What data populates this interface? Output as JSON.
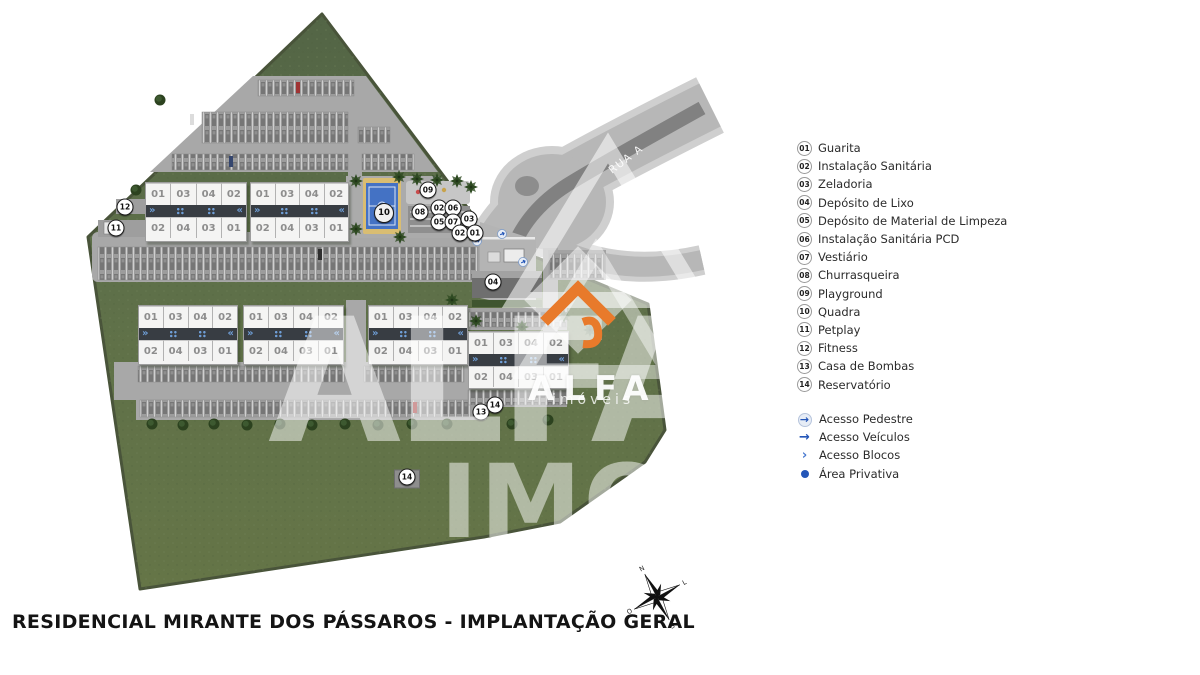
{
  "title": "RESIDENCIAL MIRANTE DOS PÁSSAROS - IMPLANTAÇÃO GERAL",
  "road": {
    "label": "RUA A"
  },
  "legend": {
    "items": [
      {
        "num": "01",
        "label": "Guarita"
      },
      {
        "num": "02",
        "label": "Instalação Sanitária"
      },
      {
        "num": "03",
        "label": "Zeladoria"
      },
      {
        "num": "04",
        "label": "Depósito de Lixo"
      },
      {
        "num": "05",
        "label": "Depósito de Material de Limpeza"
      },
      {
        "num": "06",
        "label": "Instalação Sanitária PCD"
      },
      {
        "num": "07",
        "label": "Vestiário"
      },
      {
        "num": "08",
        "label": "Churrasqueira"
      },
      {
        "num": "09",
        "label": "Playground"
      },
      {
        "num": "10",
        "label": "Quadra"
      },
      {
        "num": "11",
        "label": "Petplay"
      },
      {
        "num": "12",
        "label": "Fitness"
      },
      {
        "num": "13",
        "label": "Casa de Bombas"
      },
      {
        "num": "14",
        "label": "Reservatório"
      }
    ]
  },
  "access": {
    "items": [
      {
        "icon": "pedestrian-access-icon",
        "glyph": "→",
        "label": "Acesso Pedestre"
      },
      {
        "icon": "vehicle-access-icon",
        "glyph": "→",
        "label": "Acesso Veículos"
      },
      {
        "icon": "block-access-icon",
        "glyph": "›",
        "label": "Acesso Blocos"
      },
      {
        "icon": "private-area-icon",
        "glyph": "",
        "label": "Área Privativa"
      }
    ]
  },
  "plan": {
    "top_units": [
      "01",
      "03",
      "04",
      "02"
    ],
    "bottom_units": [
      "02",
      "04",
      "03",
      "01"
    ],
    "chevron_left": "»",
    "chevron_right": "«",
    "blocks": [
      {
        "x": 145,
        "y": 182,
        "w": 100,
        "h": 58
      },
      {
        "x": 250,
        "y": 182,
        "w": 97,
        "h": 58
      },
      {
        "x": 138,
        "y": 305,
        "w": 98,
        "h": 58
      },
      {
        "x": 243,
        "y": 305,
        "w": 99,
        "h": 58
      },
      {
        "x": 368,
        "y": 305,
        "w": 98,
        "h": 58
      },
      {
        "x": 468,
        "y": 331,
        "w": 99,
        "h": 56
      }
    ],
    "badges": [
      {
        "n": "12",
        "x": 125,
        "y": 207
      },
      {
        "n": "11",
        "x": 116,
        "y": 228
      },
      {
        "n": "09",
        "x": 428,
        "y": 190
      },
      {
        "n": "10",
        "x": 384,
        "y": 213,
        "size": "lg"
      },
      {
        "n": "08",
        "x": 420,
        "y": 212
      },
      {
        "n": "02",
        "x": 439,
        "y": 208
      },
      {
        "n": "06",
        "x": 453,
        "y": 208
      },
      {
        "n": "05",
        "x": 439,
        "y": 222
      },
      {
        "n": "07",
        "x": 453,
        "y": 222
      },
      {
        "n": "03",
        "x": 469,
        "y": 219
      },
      {
        "n": "02",
        "x": 460,
        "y": 233
      },
      {
        "n": "01",
        "x": 475,
        "y": 233
      },
      {
        "n": "04",
        "x": 493,
        "y": 282
      },
      {
        "n": "13",
        "x": 481,
        "y": 412
      },
      {
        "n": "14",
        "x": 495,
        "y": 405
      },
      {
        "n": "14",
        "x": 407,
        "y": 477,
        "plate": true
      }
    ],
    "compass": {
      "n": "N",
      "e": "L",
      "s": "S",
      "w": "O"
    }
  },
  "watermark": {
    "brand": "ALFA",
    "brand_sub": "imóveis",
    "giant_top": "ALFA",
    "giant_bottom": "IMO"
  },
  "colors": {
    "site_green": "#5e7049",
    "road_gray": "#b7b7b7",
    "accent_blue": "#2456b8",
    "brand_orange": "#e87a2b"
  }
}
